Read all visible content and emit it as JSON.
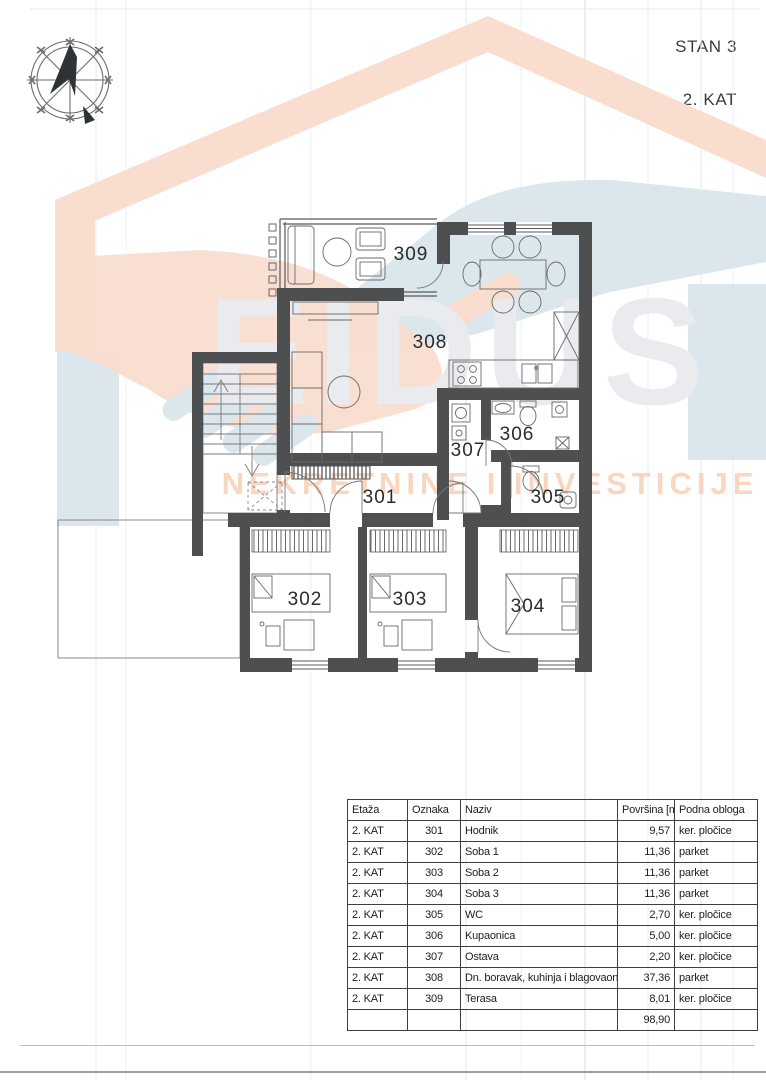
{
  "header": {
    "apartment_label": "STAN 3",
    "floor_label": "2. KAT"
  },
  "watermark": {
    "brand": "EIDUS",
    "tagline": "NEKRETNINE I INVESTICIJE",
    "logo_icon": "house-handshake-icon",
    "colors": {
      "salmon": "#f9ddcf",
      "blue": "#dbe7ec",
      "title": "#e9ebee",
      "tagline": "#f8cfb4"
    }
  },
  "plan": {
    "wall_color": "#4d4f51",
    "room_labels": {
      "r301": "301",
      "r302": "302",
      "r303": "303",
      "r304": "304",
      "r305": "305",
      "r306": "306",
      "r307": "307",
      "r308": "308",
      "r309": "309"
    }
  },
  "area_table": {
    "headers": {
      "etaza": "Etaža",
      "oznaka": "Oznaka",
      "naziv": "Naziv",
      "povrsina": "Površina [m²]",
      "obloga": "Podna obloga"
    },
    "rows": [
      {
        "etaza": "2. KAT",
        "oznaka": "301",
        "naziv": "Hodnik",
        "povrsina": "9,57",
        "obloga": "ker. pločice"
      },
      {
        "etaza": "2. KAT",
        "oznaka": "302",
        "naziv": "Soba 1",
        "povrsina": "11,36",
        "obloga": "parket"
      },
      {
        "etaza": "2. KAT",
        "oznaka": "303",
        "naziv": "Soba 2",
        "povrsina": "11,36",
        "obloga": "parket"
      },
      {
        "etaza": "2. KAT",
        "oznaka": "304",
        "naziv": "Soba 3",
        "povrsina": "11,36",
        "obloga": "parket"
      },
      {
        "etaza": "2. KAT",
        "oznaka": "305",
        "naziv": "WC",
        "povrsina": "2,70",
        "obloga": "ker. pločice"
      },
      {
        "etaza": "2. KAT",
        "oznaka": "306",
        "naziv": "Kupaonica",
        "povrsina": "5,00",
        "obloga": "ker. pločice"
      },
      {
        "etaza": "2. KAT",
        "oznaka": "307",
        "naziv": "Ostava",
        "povrsina": "2,20",
        "obloga": "ker. pločice"
      },
      {
        "etaza": "2. KAT",
        "oznaka": "308",
        "naziv": "Dn. boravak, kuhinja i blagovaonica",
        "povrsina": "37,36",
        "obloga": "parket"
      },
      {
        "etaza": "2. KAT",
        "oznaka": "309",
        "naziv": "Terasa",
        "povrsina": "8,01",
        "obloga": "ker. pločice"
      }
    ],
    "total": {
      "povrsina": "98,90"
    }
  }
}
